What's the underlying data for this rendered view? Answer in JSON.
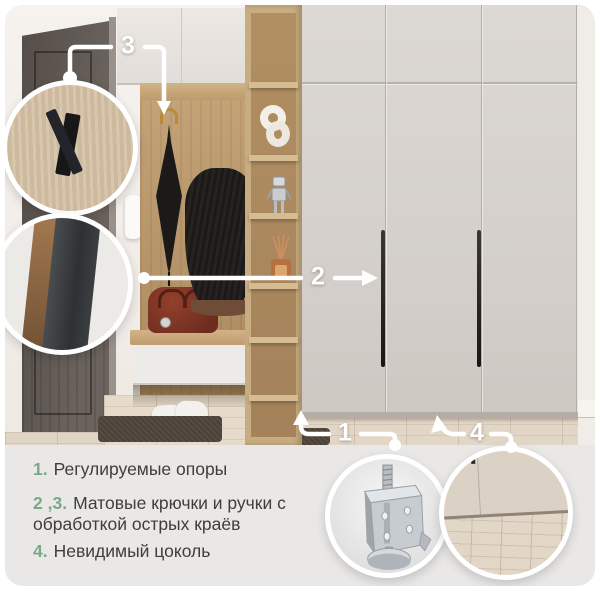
{
  "features": {
    "items": [
      {
        "num": "1.",
        "text": "Регулируемые опоры"
      },
      {
        "num": "2 ,3.",
        "text": "Матовые крючки и ручки с обработкой острых краёв"
      },
      {
        "num": "4.",
        "text": "Невидимый цоколь"
      }
    ]
  },
  "callouts": {
    "labels": [
      "1",
      "2",
      "3",
      "4"
    ]
  },
  "colors": {
    "accent_green": "#7ca88a",
    "panel_bg": "#e9e8e6",
    "text": "#3f3e3c",
    "callout_white": "#ffffff",
    "wardrobe_beige": "#d6d2cd",
    "oak_wood": "#c2a274",
    "entry_door_dark": "#5d5550",
    "floor_beige": "#e2d6c6"
  },
  "insets": {
    "top_left": "matte-hook-closeup",
    "mid_left": "handle-edge-closeup",
    "bottom_left": "adjustable-support-leg",
    "bottom_right": "invisible-plinth-closeup"
  }
}
